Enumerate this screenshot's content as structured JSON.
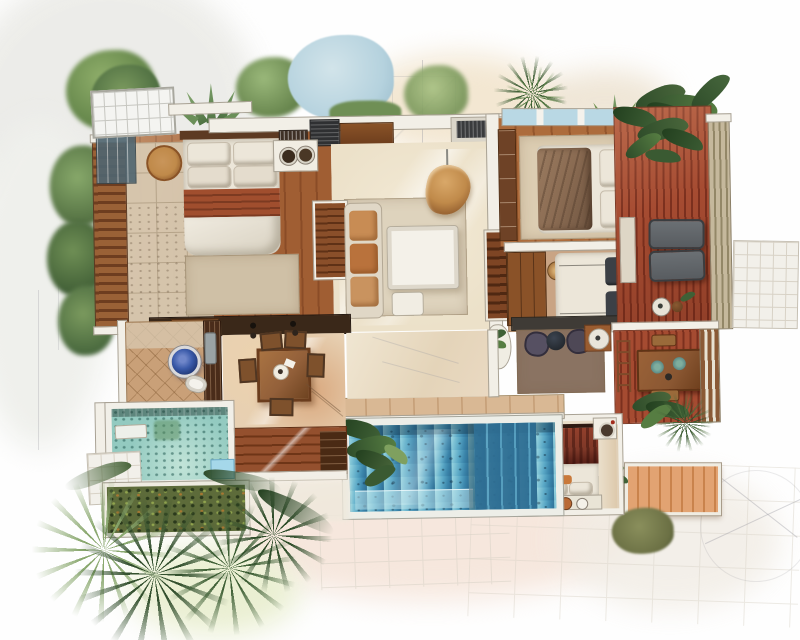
{
  "scene": {
    "kind": "watercolor-architectural-floor-plan",
    "view": "top-down",
    "text_visible": false
  },
  "rooms": [
    {
      "id": "master-bedroom",
      "features": [
        "double-bed",
        "round-side-table",
        "rug",
        "louvered-screen-wall",
        "concrete-floor",
        "wood-floor"
      ]
    },
    {
      "id": "vanity",
      "features": [
        "counter",
        "twin-round-basins",
        "dark-wardrobe"
      ]
    },
    {
      "id": "living-room",
      "features": [
        "sofa",
        "coffee-table",
        "ottoman",
        "hanging-egg-chair",
        "area-rug",
        "louvered-window"
      ]
    },
    {
      "id": "bedroom-2",
      "features": [
        "bed-with-throw-blanket",
        "closet",
        "skylight-band",
        "rug"
      ]
    },
    {
      "id": "bedroom-3",
      "features": [
        "bed-dark-pillows",
        "wardrobe",
        "round-basket",
        "rug"
      ]
    },
    {
      "id": "lounge-nook",
      "features": [
        "two-poufs",
        "dark-round-table",
        "white-side-table",
        "rug",
        "planter-desk"
      ]
    },
    {
      "id": "sun-deck",
      "features": [
        "red-plank-decking",
        "two-loungers",
        "side-table",
        "slatted-screen",
        "tiled-patio",
        "overhanging-plants"
      ]
    },
    {
      "id": "outdoor-dining-deck",
      "features": [
        "wood-table",
        "place-settings",
        "benches",
        "ladder-shelf",
        "slatted-screen",
        "plants"
      ]
    },
    {
      "id": "pool-cabana-bedroom",
      "features": [
        "canopy-bed-red-drapes",
        "pillow-bench",
        "flower-pots",
        "wash-basin"
      ]
    },
    {
      "id": "main-pool",
      "features": [
        "blue-water",
        "entry-steps",
        "shallow-ledge",
        "overhanging-plant",
        "stone-back-wall"
      ]
    },
    {
      "id": "bathroom",
      "features": [
        "blue-vessel-basin",
        "toilet",
        "gray-bench",
        "dark-partition",
        "diagonal-tile-floor"
      ]
    },
    {
      "id": "dining-room",
      "features": [
        "square-wood-table",
        "six-chairs",
        "terracotta-floor-wash"
      ]
    },
    {
      "id": "plunge-pool",
      "features": [
        "speckled-aqua-water",
        "white-surround",
        "towel-ledge",
        "blue-step"
      ]
    },
    {
      "id": "garden-planter",
      "features": [
        "framed-shrub-bed"
      ]
    },
    {
      "id": "outdoor-stairs",
      "features": [
        "terracotta-treads"
      ]
    }
  ],
  "vegetation": [
    "top-left-trees",
    "agave-cluster",
    "blue-speckled-tree",
    "hedge-row",
    "top-palm",
    "tropical-leaves-over-deck",
    "left-edge-trees",
    "pool-corner-plant",
    "bottom-left-fan-palms",
    "dark-fern-palm",
    "olive-tree",
    "palm-by-stairs",
    "small-tufts"
  ],
  "palette": {
    "wall": "#f2efe7",
    "wallline": "#a9a294",
    "wood1": "#a05e33",
    "wood2": "#8a4c27",
    "woodA1": "#ad6c3c",
    "woodA2": "#94562c",
    "deck1": "#a54b31",
    "deck2": "#7c301e",
    "concrete": "#d8c9b1",
    "concreteline": "#b7a78d",
    "linen": "#ece6d9",
    "stripe1": "#a04e2e",
    "stripe2": "#7c3a21",
    "headboard": "#5d3a22",
    "darkwood": "#3a2819",
    "rugbeige": "#cfc0a6",
    "ruglight": "#dccdb2",
    "rugliving": "#ded3bd",
    "rugtan": "#c9a484",
    "rugnook": "#8a7362",
    "sofa": "#e0d7c6",
    "cushion1": "#c88c54",
    "cushion2": "#b9723c",
    "cushion3": "#c9935f",
    "tablewhite": "#f4f1e9",
    "rattan1": "#c08a4a",
    "rattan2": "#7e4a22",
    "louver1": "#9a6136",
    "louver2": "#6e3d1f",
    "shutter1": "#8a4f2a",
    "shutter2": "#5f3116",
    "wardrobe": "#8a5228",
    "closet": "#6e4226",
    "grill": "#2f3032",
    "blanket": "#8a6b52",
    "pillowdark": "#3c4046",
    "ironframe": "#2c2623",
    "pouf": "#565062",
    "poufdark": "#23282e",
    "lounger": "#585c60",
    "loungerline": "#3a3d40",
    "screen1": "#c5b89c",
    "screen2": "#938767",
    "screenb1": "#8a5a36",
    "screenb2": "#e8e2d2",
    "dining": "#8a5732",
    "diningedge": "#5f3416",
    "plate": "#5b8a86",
    "stair1": "#e2a372",
    "stair2": "#c9834c",
    "drape1": "#7e3828",
    "drape2": "#551f16",
    "pot": "#b96a35",
    "pool1": "#9ad6e0",
    "pool2": "#5aa8c6",
    "pool3": "#2e6d92",
    "poolstep": "#58a0c0",
    "plunge": "#93cac0",
    "plungelight": "#c2e4d8",
    "bluestep": "#a5d8ea",
    "basinring": "#d9d9db",
    "basin1": "#3a5aa9",
    "basin2": "#16285e",
    "bathtile": "#c9a078",
    "bathline": "#8a5f38",
    "terra": "#e0b896",
    "stone": "#d9b894",
    "stoneline": "#b98f66",
    "skyl": "#f4f4f1",
    "skygrid": "#c6c6c0",
    "pane": "#b9d8e4",
    "green1": "#6f9150",
    "green2": "#4a6b3b",
    "green3": "#2f4d2a",
    "green4": "#8aa86f",
    "green5": "#567d42",
    "olive": "#6b7044",
    "bluetree": "#b5d2de",
    "bluetreedot": "#7fa6bc",
    "washgray": "#ebebe7",
    "washwarm": "#f3e7d2",
    "washpink": "#f6e7dd",
    "washgreen": "#eaefd2",
    "washtan": "#efe9dc",
    "sketchline": "#9a9aa2",
    "patio": "#f2f0ea",
    "patioline": "#d8d2c6",
    "livingfloor": "#ece1c9",
    "masterfloorlight": "#b5713f"
  }
}
